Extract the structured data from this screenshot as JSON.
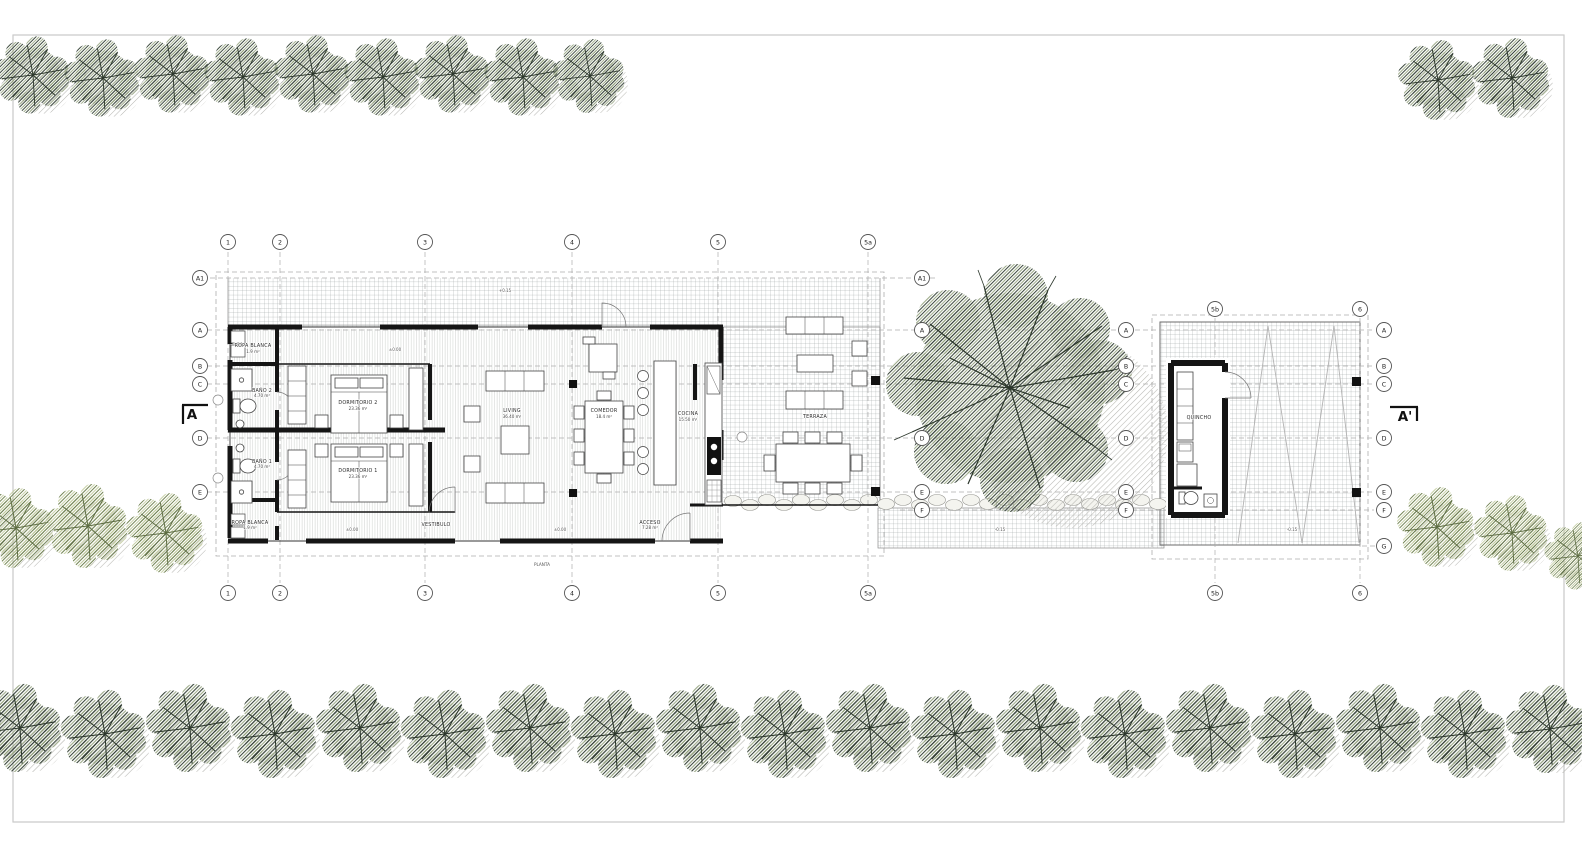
{
  "drawing": {
    "type": "architectural floor plan",
    "note": "PLANTA"
  },
  "grid": {
    "cols": [
      "1",
      "2",
      "3",
      "4",
      "5",
      "5a",
      "5b",
      "6"
    ],
    "rows": [
      "A1",
      "A",
      "B",
      "C",
      "D",
      "E",
      "F",
      "G"
    ]
  },
  "sections": {
    "left": "A",
    "right": "A'"
  },
  "rooms": {
    "ropa_blanca_1": {
      "name": "ROPA BLANCA",
      "area": "1.9 m²"
    },
    "bano_2": {
      "name": "BAÑO 2",
      "area": "4.70 m²"
    },
    "bano_1": {
      "name": "BAÑO 1",
      "area": "4.70 m²"
    },
    "dormitorio_2": {
      "name": "DORMITORIO 2",
      "area": "23.36 m²"
    },
    "dormitorio_1": {
      "name": "DORMITORIO 1",
      "area": "23.36 m²"
    },
    "living": {
      "name": "LIVING",
      "area": "36.40 m²"
    },
    "comedor": {
      "name": "COMEDOR",
      "area": "18.4 m²"
    },
    "cocina": {
      "name": "COCINA",
      "area": "15.50 m²"
    },
    "vestibulo": {
      "name": "VESTIBULO",
      "area": ""
    },
    "acceso": {
      "name": "ACCESO",
      "area": "7.28 m²"
    },
    "ropa_blanca_2": {
      "name": "ROPA BLANCA",
      "area": "1.9 m²"
    },
    "terraza": {
      "name": "TERRAZA",
      "area": ""
    },
    "quincho": {
      "name": "QUINCHO",
      "area": ""
    }
  },
  "levels": {
    "interior": "±0.00",
    "deck": "+0.15",
    "walkway": "-0.15"
  },
  "colors": {
    "wall": "#1a1a1a",
    "tree_dark": "#3a473b",
    "tree_light": "#6f814f",
    "grid_line": "#9aa0a0",
    "dashed": "#adadad",
    "paper": "#ffffff"
  }
}
